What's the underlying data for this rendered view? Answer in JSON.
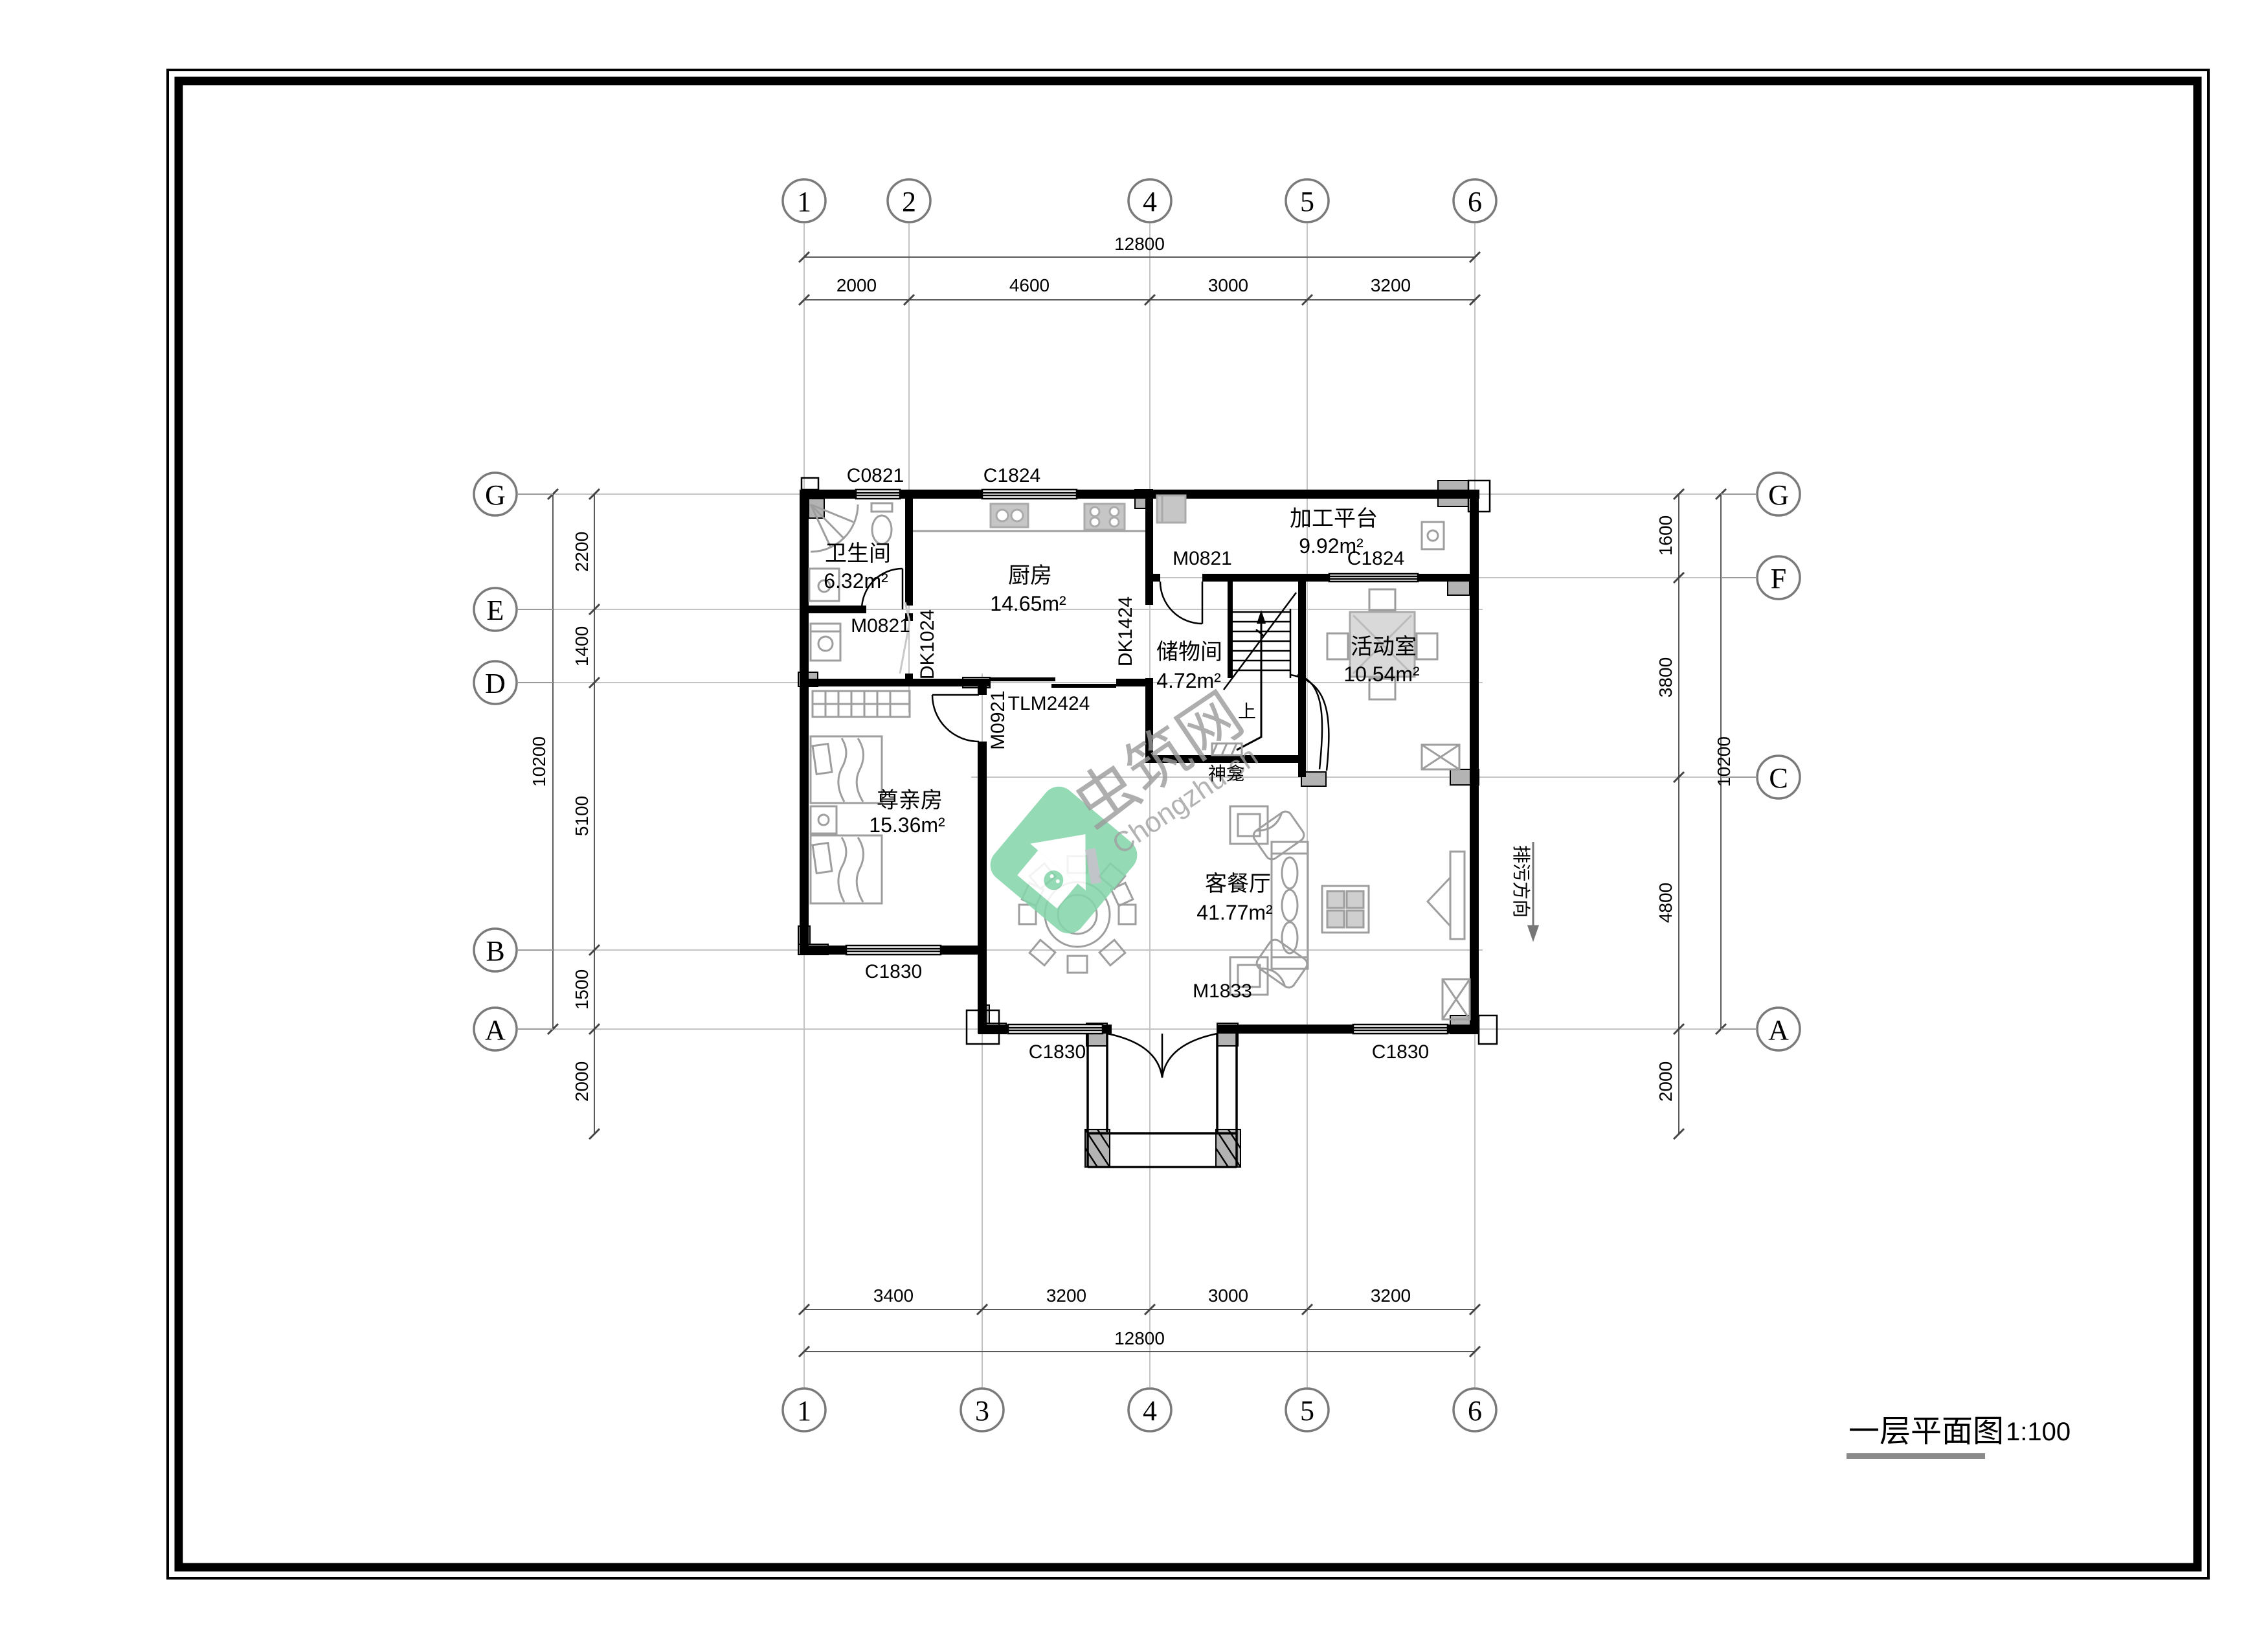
{
  "title_block": {
    "title": "一层平面图",
    "scale": "1:100"
  },
  "watermark": {
    "brand": "虫筑网",
    "domain": "Chongzhu.cn"
  },
  "grid_bubbles": {
    "top": [
      "1",
      "2",
      "4",
      "5",
      "6"
    ],
    "bottom": [
      "1",
      "3",
      "4",
      "5",
      "6"
    ],
    "left": [
      "G",
      "E",
      "D",
      "B",
      "A"
    ],
    "right": [
      "G",
      "F",
      "C",
      "A"
    ]
  },
  "dimensions": {
    "top": {
      "total": "12800",
      "segments": [
        "2000",
        "4600",
        "3000",
        "3200"
      ]
    },
    "bottom": {
      "total": "12800",
      "segments": [
        "3400",
        "3200",
        "3000",
        "3200"
      ]
    },
    "left": {
      "total": "10200",
      "segments": [
        "2200",
        "1400",
        "5100",
        "1500",
        "2000"
      ]
    },
    "right": {
      "total": "10200",
      "segments": [
        "1600",
        "3800",
        "4800",
        "2000"
      ]
    }
  },
  "rooms": {
    "bathroom": {
      "name": "卫生间",
      "area": "6.32m²"
    },
    "kitchen": {
      "name": "厨房",
      "area": "14.65m²"
    },
    "platform": {
      "name": "加工平台",
      "area": "9.92m²"
    },
    "storage": {
      "name": "储物间",
      "area": "4.72m²"
    },
    "activity": {
      "name": "活动室",
      "area": "10.54m²"
    },
    "bedroom": {
      "name": "尊亲房",
      "area": "15.36m²"
    },
    "living": {
      "name": "客餐厅",
      "area": "41.77m²"
    }
  },
  "openings": {
    "c0821": "C0821",
    "c1824_kitchen": "C1824",
    "m0821_bathroom": "M0821",
    "dk1024": "DK1024",
    "dk1424": "DK1424",
    "m0821_platform": "M0821",
    "c1824_platform": "C1824",
    "tlm2424": "TLM2424",
    "m0921": "M0921",
    "c1830_bedroom": "C1830",
    "c1830_entry_left": "C1830",
    "m1833": "M1833",
    "c1830_entry_right": "C1830"
  },
  "annotations": {
    "stair_up": "上",
    "shrine": "神龛",
    "sewage_direction": "排污方向"
  }
}
